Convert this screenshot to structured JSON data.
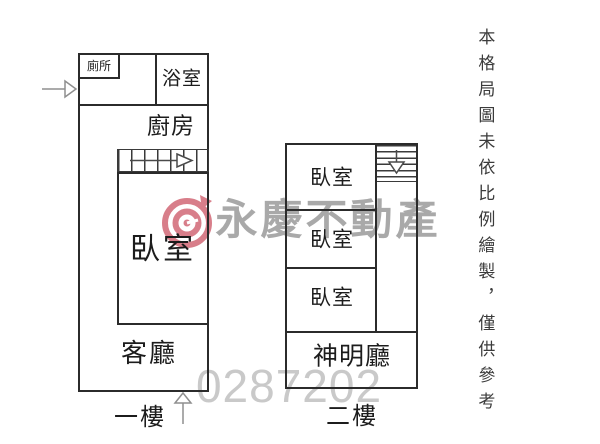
{
  "disclaimer": "本格局圖未依比例繪製，僅供參考",
  "watermark": {
    "brand": "永慶不動產",
    "code": "0287202",
    "logo_color": "#cf5f6d",
    "brand_text_color": "#a9a9a9",
    "code_text_color": "#c9c9c9"
  },
  "floors": {
    "floor1": {
      "label": "一樓",
      "rooms": {
        "toilet": "廁所",
        "bathroom": "浴室",
        "kitchen": "廚房",
        "bedroom": "臥室",
        "living_room": "客廳"
      }
    },
    "floor2": {
      "label": "二樓",
      "rooms": {
        "bedroom1": "臥室",
        "bedroom2": "臥室",
        "bedroom3": "臥室",
        "shrine_hall": "神明廳"
      }
    }
  },
  "colors": {
    "wall": "#2b2b2b"
  }
}
